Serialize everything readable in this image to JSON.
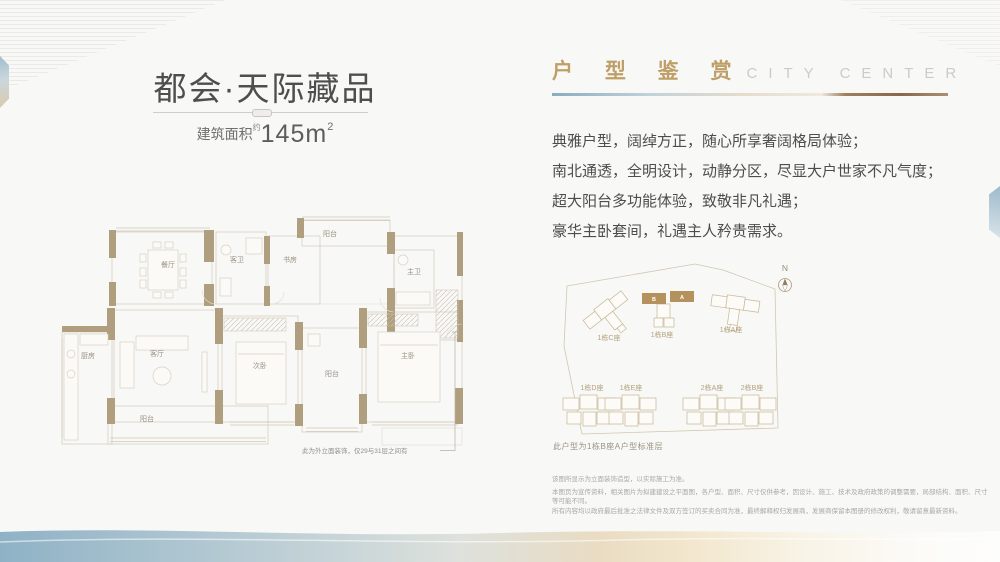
{
  "header_left": {
    "title": "都会·天际藏品",
    "area_label": "建筑面积",
    "area_approx": "约",
    "area_value": "145m",
    "area_sup": "2"
  },
  "floorplan": {
    "rooms": {
      "dining": "餐厅",
      "guest_bath": "客卫",
      "study": "书房",
      "balcony_top": "阳台",
      "master_bath": "主卫",
      "kitchen": "厨房",
      "living": "客厅",
      "second_bedroom": "次卧",
      "balcony_mid": "阳台",
      "master_bedroom": "主卧",
      "balcony_bottom": "阳台"
    },
    "note": "此为外立面装饰，仅29与31层之间有"
  },
  "showcase": {
    "title_cn": "户 型 鉴 赏",
    "title_en": "CITY CENTER",
    "lines": [
      "典雅户型，阔绰方正，随心所享奢阔格局体验；",
      "南北通透，全明设计，动静分区，尽显大户世家不凡气度；",
      "超大阳台多功能体验，致敬非凡礼遇；",
      "豪华主卧套间，礼遇主人矜贵需求。"
    ]
  },
  "siteplan": {
    "north": "N",
    "buildings": [
      "1栋C座",
      "1栋B座",
      "1栋A座",
      "1栋D座",
      "1栋E座",
      "2栋A座",
      "2栋B座"
    ],
    "highlight_units": [
      "B",
      "A"
    ],
    "caption": "此户型为1栋B座A户型标准层"
  },
  "disclaimer": [
    "该图所显示为立面装饰造型，以实际施工为准。",
    "本图页为宣传资料，相关图片为拟建建设之平面图，各户型、面积、尺寸仅供参考，因设计、施工、技术及政府政策的调整需要，局部结构、面积、尺寸等可能不同。",
    "所有内容均以政府最后批准之法律文件及双方签订的买卖合同为准，最终解释权归发展商，发展商保留本图册的修改权利，敬请留意最新资料。"
  ],
  "colors": {
    "gold_accent": "#bf9f67",
    "wall_tan": "#b09f7e",
    "band_blue": "#8fb2c6",
    "band_cream": "#f3e8cf",
    "bar_bronze": "#8a664a"
  }
}
